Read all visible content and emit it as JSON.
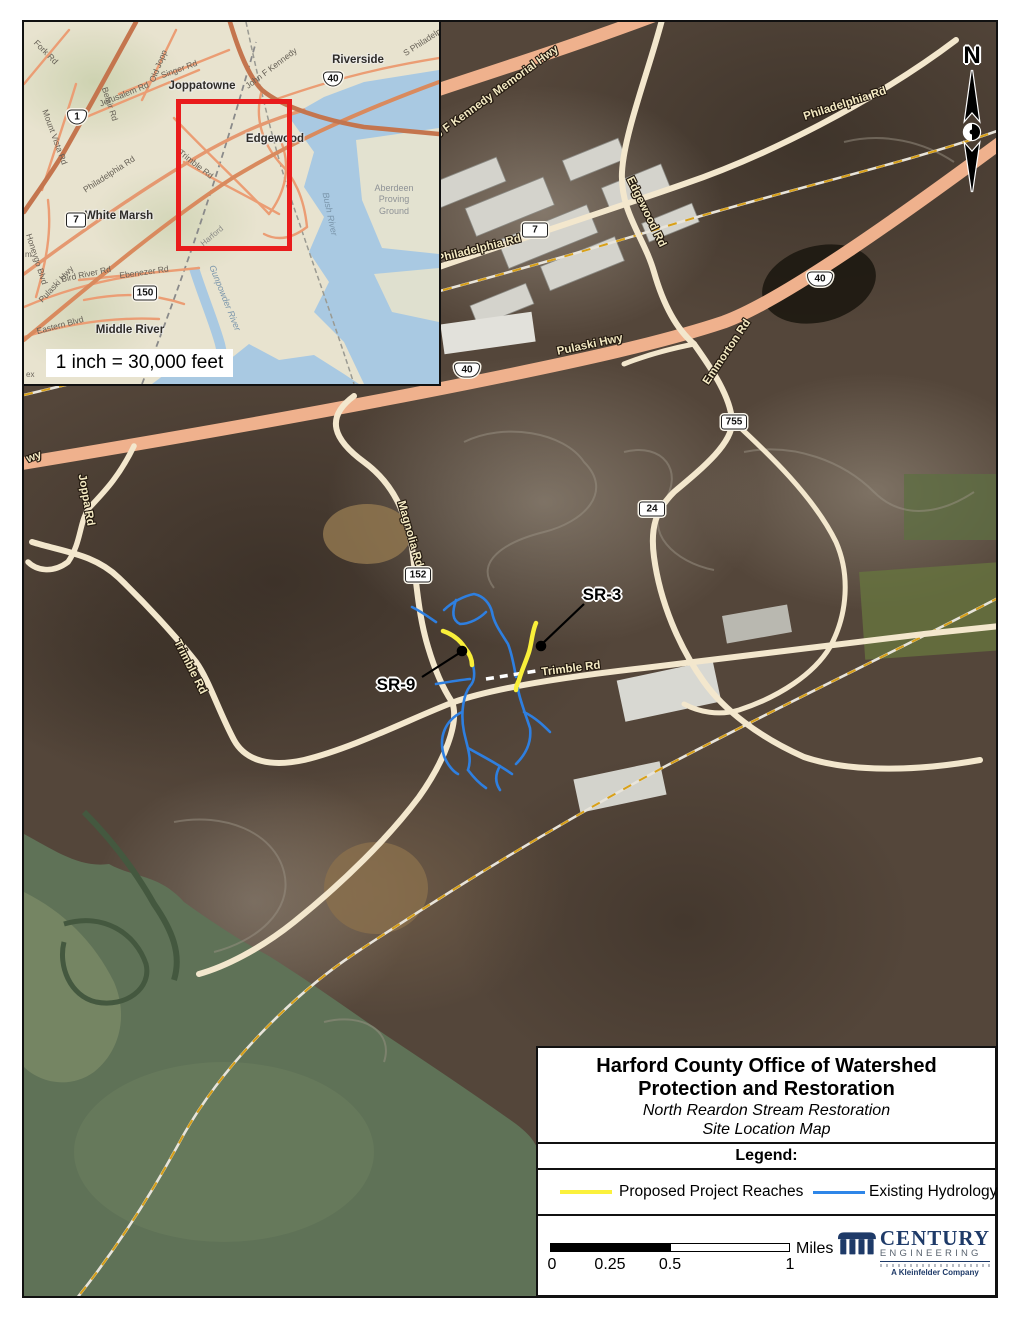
{
  "map": {
    "north": "N",
    "road_labels": [
      {
        "text": "J F Kennedy Memorial Hwy"
      },
      {
        "text": "Philadelphia Rd"
      },
      {
        "text": "Philadelphia Rd"
      },
      {
        "text": "Edgewood Rd"
      },
      {
        "text": "Pulaski Hwy"
      },
      {
        "text": "Emmorton Rd"
      },
      {
        "text": "Joppa Rd"
      },
      {
        "text": "Magnolia Rd"
      },
      {
        "text": "Trimble Rd"
      },
      {
        "text": "Trimble Rd"
      },
      {
        "text": "wy"
      }
    ],
    "shields": [
      {
        "num": "7"
      },
      {
        "num": "40"
      },
      {
        "num": "40"
      },
      {
        "num": "755"
      },
      {
        "num": "24"
      },
      {
        "num": "152"
      }
    ],
    "site_labels": [
      {
        "text": "SR-3"
      },
      {
        "text": "SR-9"
      }
    ]
  },
  "inset": {
    "scale_text": "1 inch = 30,000 feet",
    "towns": [
      {
        "name": "Joppatowne"
      },
      {
        "name": "Riverside"
      },
      {
        "name": "Edgewood"
      },
      {
        "name": "White Marsh"
      },
      {
        "name": "Middle River"
      }
    ],
    "road_labels": [
      {
        "text": "Fork Rd"
      },
      {
        "text": "Belair Rd"
      },
      {
        "text": "Old Jopp"
      },
      {
        "text": "Singer Rd"
      },
      {
        "text": "Jerusalem Rd"
      },
      {
        "text": "Mount Vista Rd"
      },
      {
        "text": "Philadelphia Rd"
      },
      {
        "text": "Trimble Rd"
      },
      {
        "text": "Pulaski Hwy"
      },
      {
        "text": "Bird River Rd"
      },
      {
        "text": "Ebenezer Rd"
      },
      {
        "text": "Eastern Blvd"
      },
      {
        "text": "Honeygo Blvd"
      },
      {
        "text": "John F Kennedy"
      },
      {
        "text": "S Philadelp"
      }
    ],
    "shields": [
      {
        "num": "1"
      },
      {
        "num": "7"
      },
      {
        "num": "40"
      },
      {
        "num": "150"
      }
    ],
    "water_labels": [
      {
        "text": "Bush River"
      },
      {
        "text": "Gunpowder River"
      }
    ],
    "area_label": "Aberdeen\nProving\nGround",
    "county_label": "Harford",
    "partials": {
      "left_edge": "m",
      "bottom_left": "ex"
    }
  },
  "legend": {
    "title_line1": "Harford County Office of Watershed",
    "title_line2": "Protection and Restoration",
    "subtitle_line1": "North Reardon Stream Restoration",
    "subtitle_line2": "Site Location Map",
    "heading": "Legend:",
    "items": [
      {
        "label": "Proposed Project Reaches",
        "color": "#fbf13c"
      },
      {
        "label": "Existing Hydrology",
        "color": "#2e86e8"
      }
    ],
    "scale": {
      "ticks": [
        "0",
        "0.25",
        "0.5",
        "1"
      ],
      "unit": "Miles"
    },
    "logo": {
      "name": "CENTURY",
      "sub": "ENGINEERING",
      "tagline": "A Kleinfelder Company"
    }
  },
  "colors": {
    "extent_box_red": "#e91c1c",
    "proposed_reach_yellow": "#f9ef3a",
    "hydrology_blue": "#2e7fe0",
    "highway_salmon": "#efb18d",
    "minor_road_cream": "#f3e7cd",
    "inset_water_blue": "#a9c9e2",
    "aerial_water_green": "#5f7257",
    "logo_navy": "#1e3a68"
  }
}
